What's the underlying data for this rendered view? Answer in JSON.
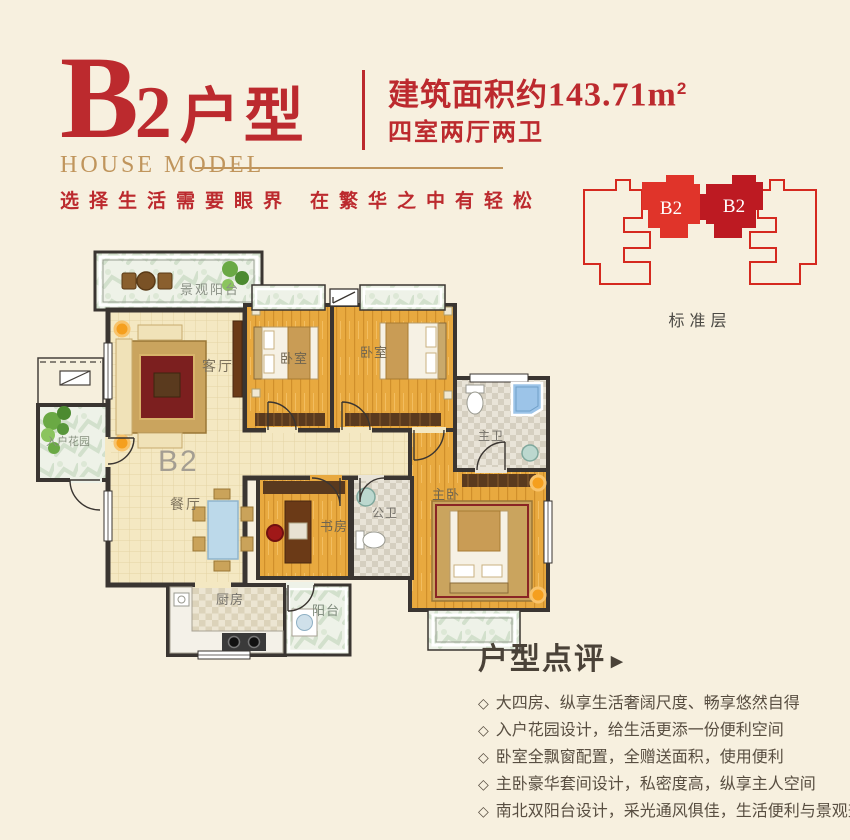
{
  "header": {
    "title_letter": "B",
    "title_number": "2",
    "title_suffix": "户型",
    "subtitle_en": "HOUSE MODEL",
    "area_prefix": "建筑面积约",
    "area_value": "143.71",
    "area_unit": "m",
    "area_sup": "2",
    "layout_line": "四室两厅两卫",
    "slogan_left": "选择生活需要眼界",
    "slogan_right": "在繁华之中有轻松"
  },
  "building": {
    "unit_labels": [
      "B2",
      "B2"
    ],
    "caption": "标准层",
    "outline_color": "#d5291f",
    "fill_left": "#e0342a",
    "fill_right": "#bd1a22"
  },
  "floorplan": {
    "unit_label": "B2",
    "rooms": [
      {
        "label": "景观阳台"
      },
      {
        "label": "客厅"
      },
      {
        "label": "卧室"
      },
      {
        "label": "卧室"
      },
      {
        "label": "主卫"
      },
      {
        "label": "主卧"
      },
      {
        "label": "餐厅"
      },
      {
        "label": "书房"
      },
      {
        "label": "公卫"
      },
      {
        "label": "厨房"
      },
      {
        "label": "阳台"
      },
      {
        "label": "入户花园"
      }
    ]
  },
  "review": {
    "heading": "户型点评",
    "arrow_icon": "▶",
    "bullet_icon": "◇",
    "items": [
      "大四房、纵享生活奢阔尺度、畅享悠然自得",
      "入户花园设计，给生活更添一份便利空间",
      "卧室全飘窗配置，全赠送面积，使用便利",
      "主卧豪华套间设计，私密度高，纵享主人空间",
      "南北双阳台设计，采光通风俱佳，生活便利与景观兼得"
    ]
  },
  "colors": {
    "background": "#f7f0df",
    "title_red": "#bc2a2e",
    "gold": "#c0955c",
    "wall": "#3a3531",
    "wood_floor": "#e8a93f",
    "cream_tile": "#f4e8c2",
    "caption_gray": "#4c4a45"
  }
}
